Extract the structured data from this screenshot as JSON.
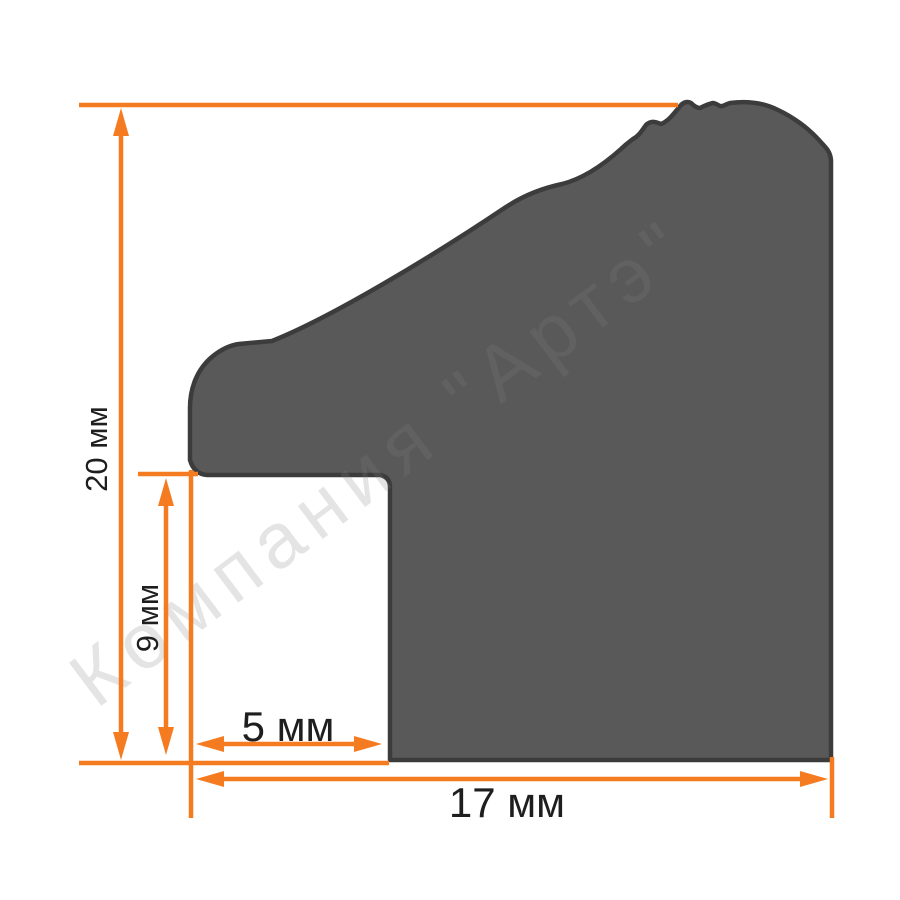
{
  "watermark": {
    "text": "Компания \"Артэ\""
  },
  "dimensions": {
    "overall_height": {
      "value": 20,
      "unit": "мм",
      "label": "20 мм"
    },
    "rabbet_depth": {
      "value": 9,
      "unit": "мм",
      "label": "9 мм"
    },
    "rabbet_width": {
      "value": 5,
      "unit": "мм",
      "label": "5 мм"
    },
    "overall_width": {
      "value": 17,
      "unit": "мм",
      "label": "17 мм"
    }
  },
  "colors": {
    "accent": "#F47B20",
    "profile_fill": "#595959",
    "profile_stroke": "#3C3C3C",
    "label_text": "#1E1E1E"
  }
}
